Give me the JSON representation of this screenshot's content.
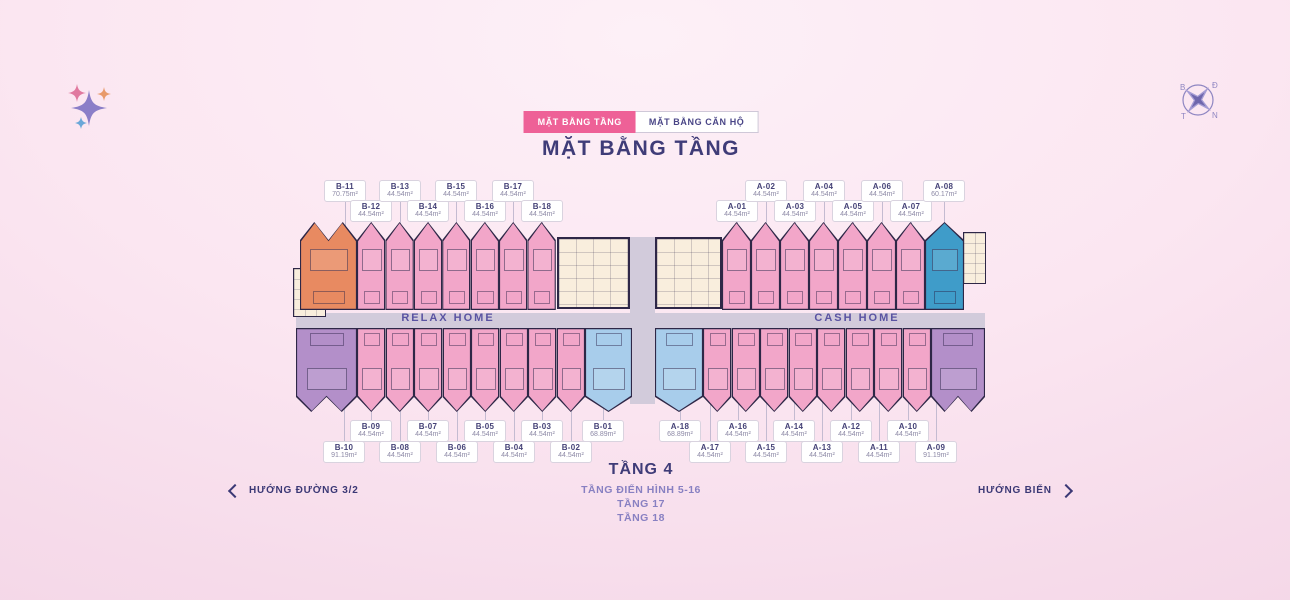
{
  "tabs": [
    {
      "label": "MẶT BẰNG TẦNG",
      "active": true
    },
    {
      "label": "MẶT BẰNG CĂN HỘ",
      "active": false
    }
  ],
  "title": "MẶT BẰNG TẦNG",
  "corridor": {
    "left_label": "RELAX HOME",
    "right_label": "CASH HOME"
  },
  "floor_info": {
    "current": "TẦNG 4",
    "lines": [
      "TẦNG ĐIỂN HÌNH 5-16",
      "TẦNG 17",
      "TẦNG 18"
    ]
  },
  "directions": {
    "left": "HƯỚNG ĐƯỜNG 3/2",
    "right": "HƯỚNG BIỂN"
  },
  "compass": {
    "letters": {
      "nw": "B",
      "ne": "Đ",
      "se": "N",
      "sw": "T"
    }
  },
  "colors": {
    "accent_pink": "#ee6197",
    "heading_indigo": "#3f3c78",
    "sub_purple": "#8880c2",
    "unit_pink": "#f2a6c9",
    "unit_orange": "#e88a61",
    "unit_purple": "#b38fc9",
    "unit_light_blue": "#a8cdeb",
    "unit_teal": "#3f9cc9",
    "corridor_grey": "#d2cbdb",
    "core_cream": "#f9eedd"
  },
  "plan": {
    "units": [
      {
        "id": "B-11",
        "area": "70.75m²",
        "color": "orange"
      },
      {
        "id": "B-12",
        "area": "44.54m²",
        "color": "pink"
      },
      {
        "id": "B-13",
        "area": "44.54m²",
        "color": "pink"
      },
      {
        "id": "B-14",
        "area": "44.54m²",
        "color": "pink"
      },
      {
        "id": "B-15",
        "area": "44.54m²",
        "color": "pink"
      },
      {
        "id": "B-16",
        "area": "44.54m²",
        "color": "pink"
      },
      {
        "id": "B-17",
        "area": "44.54m²",
        "color": "pink"
      },
      {
        "id": "B-18",
        "area": "44.54m²",
        "color": "pink"
      },
      {
        "id": "A-01",
        "area": "44.54m²",
        "color": "pink"
      },
      {
        "id": "A-02",
        "area": "44.54m²",
        "color": "pink"
      },
      {
        "id": "A-03",
        "area": "44.54m²",
        "color": "pink"
      },
      {
        "id": "A-04",
        "area": "44.54m²",
        "color": "pink"
      },
      {
        "id": "A-05",
        "area": "44.54m²",
        "color": "pink"
      },
      {
        "id": "A-06",
        "area": "44.54m²",
        "color": "pink"
      },
      {
        "id": "A-07",
        "area": "44.54m²",
        "color": "pink"
      },
      {
        "id": "A-08",
        "area": "60.17m²",
        "color": "teal"
      },
      {
        "id": "B-10",
        "area": "91.19m²",
        "color": "purple"
      },
      {
        "id": "B-09",
        "area": "44.54m²",
        "color": "pink"
      },
      {
        "id": "B-08",
        "area": "44.54m²",
        "color": "pink"
      },
      {
        "id": "B-07",
        "area": "44.54m²",
        "color": "pink"
      },
      {
        "id": "B-06",
        "area": "44.54m²",
        "color": "pink"
      },
      {
        "id": "B-05",
        "area": "44.54m²",
        "color": "pink"
      },
      {
        "id": "B-04",
        "area": "44.54m²",
        "color": "pink"
      },
      {
        "id": "B-03",
        "area": "44.54m²",
        "color": "pink"
      },
      {
        "id": "B-02",
        "area": "44.54m²",
        "color": "pink"
      },
      {
        "id": "B-01",
        "area": "68.89m²",
        "color": "blue"
      },
      {
        "id": "A-18",
        "area": "68.89m²",
        "color": "blue"
      },
      {
        "id": "A-17",
        "area": "44.54m²",
        "color": "pink"
      },
      {
        "id": "A-16",
        "area": "44.54m²",
        "color": "pink"
      },
      {
        "id": "A-15",
        "area": "44.54m²",
        "color": "pink"
      },
      {
        "id": "A-14",
        "area": "44.54m²",
        "color": "pink"
      },
      {
        "id": "A-13",
        "area": "44.54m²",
        "color": "pink"
      },
      {
        "id": "A-12",
        "area": "44.54m²",
        "color": "pink"
      },
      {
        "id": "A-11",
        "area": "44.54m²",
        "color": "pink"
      },
      {
        "id": "A-10",
        "area": "44.54m²",
        "color": "pink"
      },
      {
        "id": "A-09",
        "area": "91.19m²",
        "color": "purple"
      }
    ]
  }
}
